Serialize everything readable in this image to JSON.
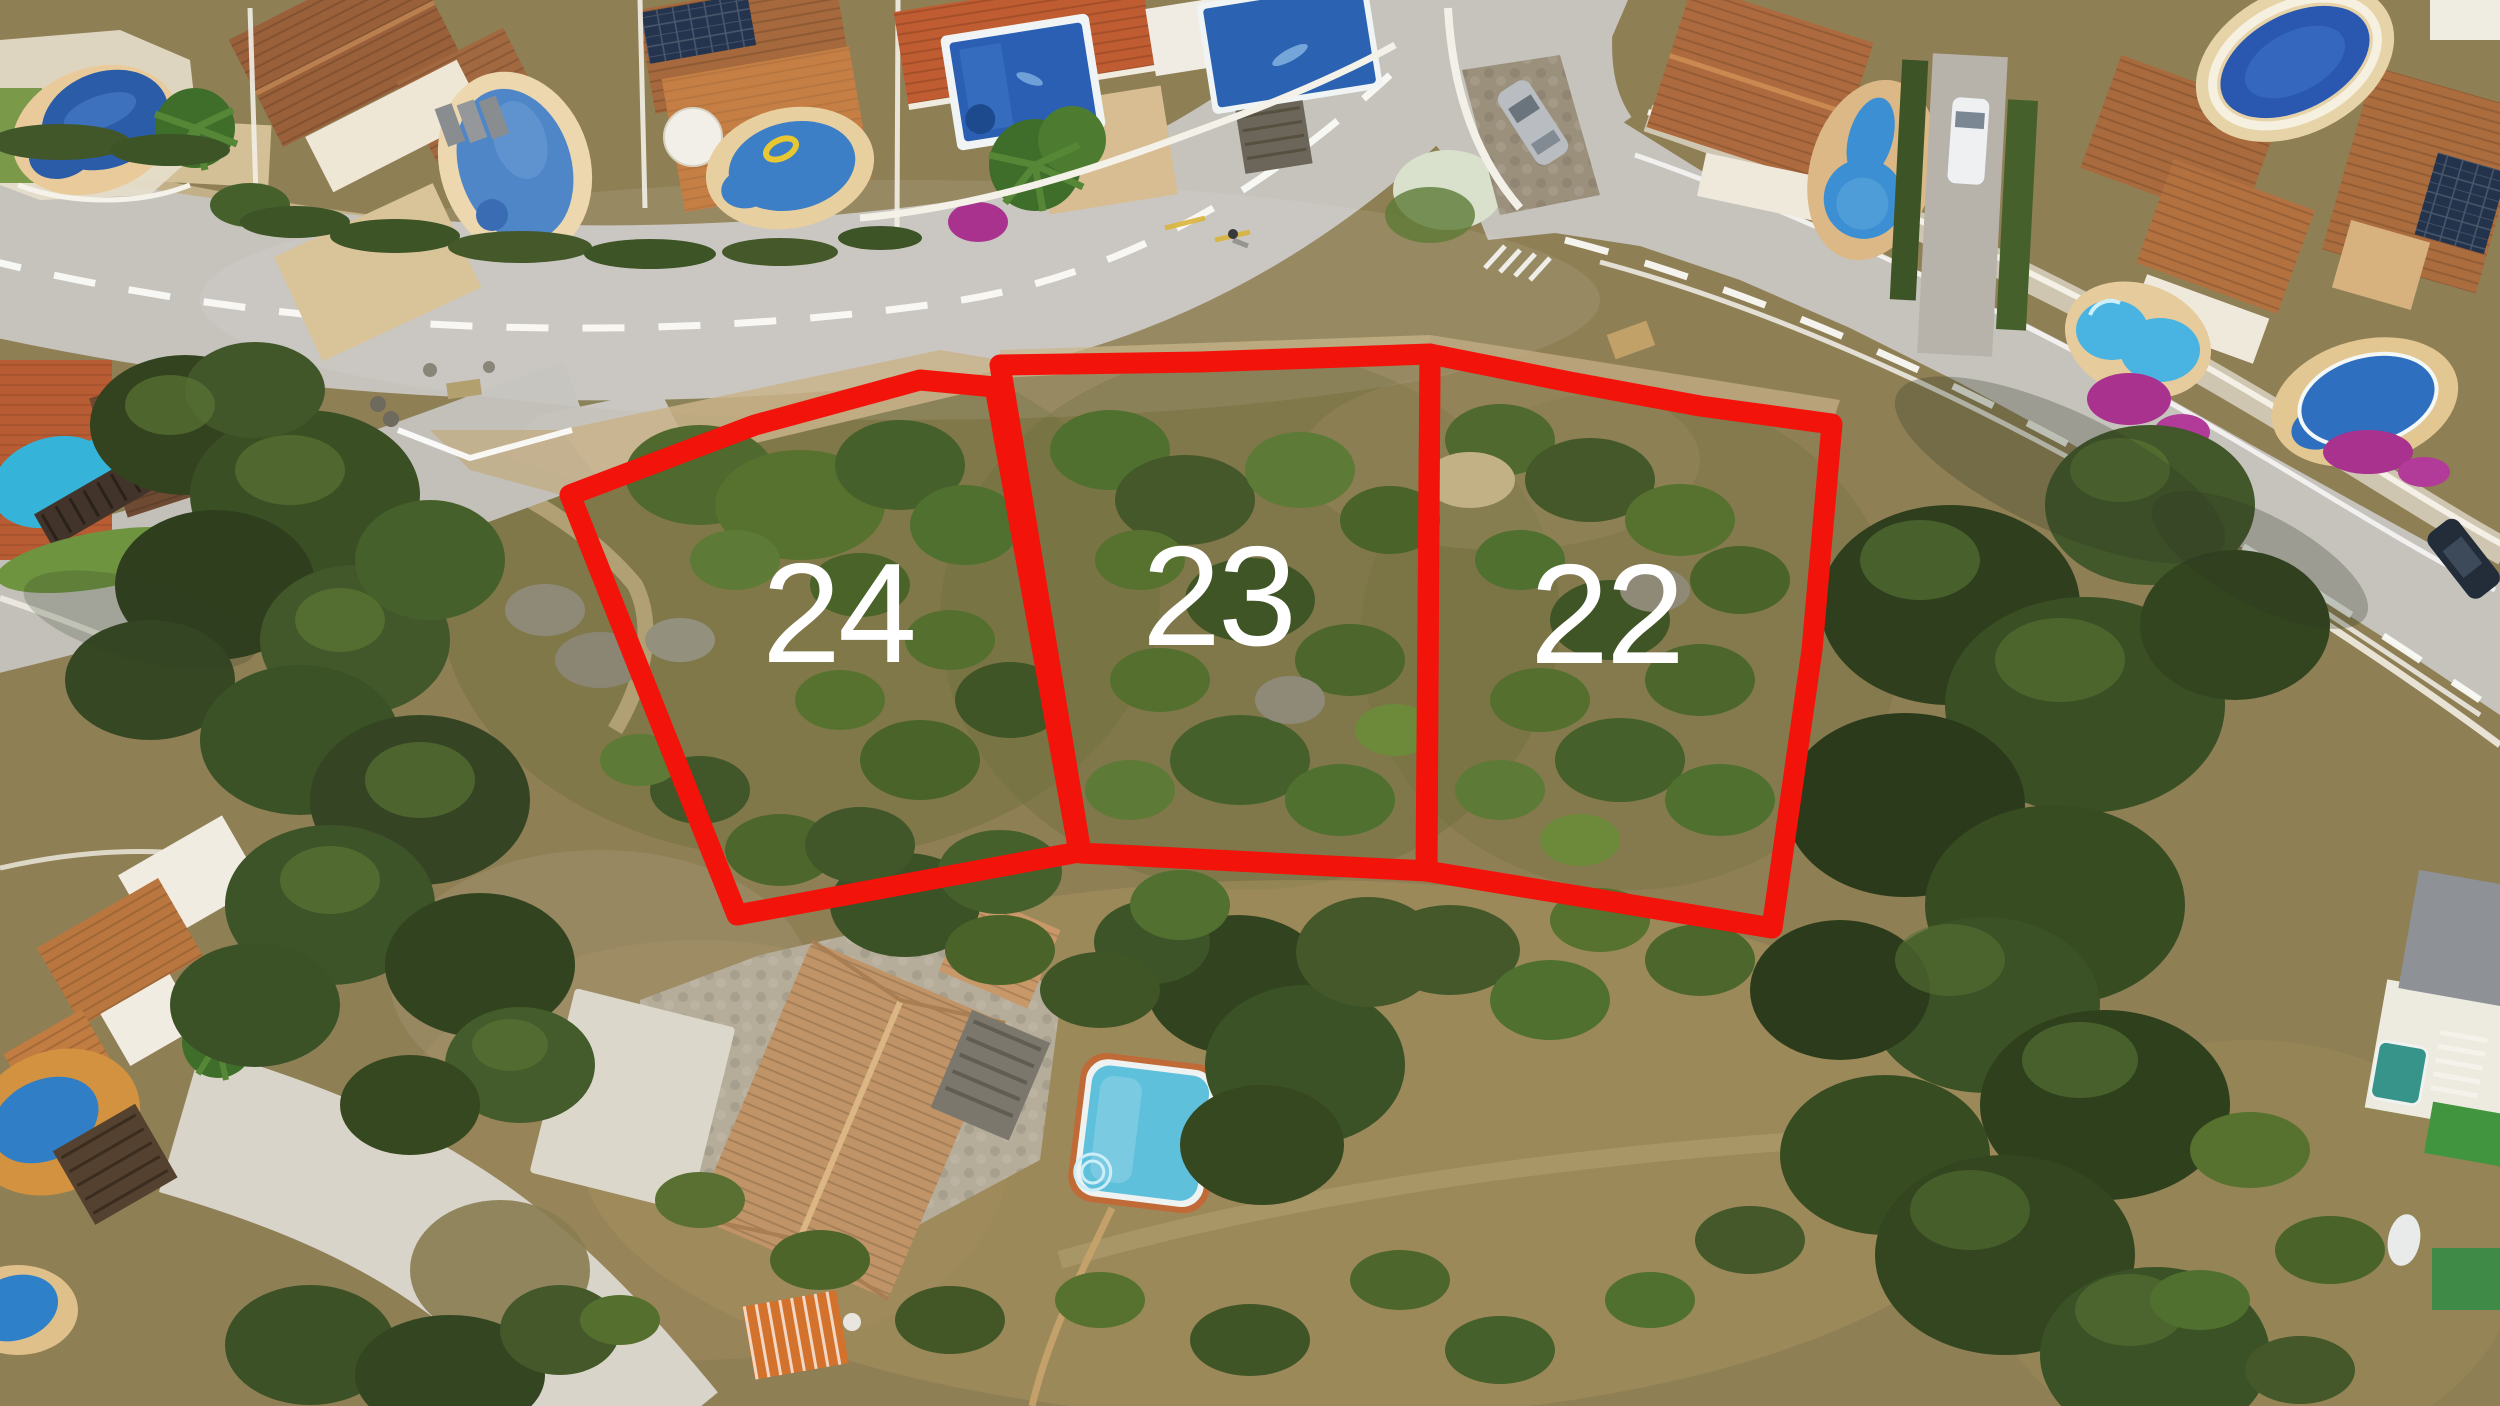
{
  "image": {
    "kind": "aerial-drone-photo-with-plot-annotation",
    "width": 2500,
    "height": 1406
  },
  "annotation": {
    "boundary_color": "#f2130a",
    "stroke_width": 21,
    "label_color": "#ffffff",
    "label_font_size": 142,
    "plots": [
      {
        "id": "plot-24",
        "label": "24",
        "points": "570,495 755,425 920,380 995,387 1079,852 737,915",
        "label_x": 838,
        "label_y": 662
      },
      {
        "id": "plot-23",
        "label": "23",
        "points": "1000,365 1200,362 1430,354 1427,871 1081,853",
        "label_x": 1218,
        "label_y": 645
      },
      {
        "id": "plot-22",
        "label": "22",
        "points": "1430,354 1570,382 1700,406 1832,424 1812,650 1772,928 1426,871",
        "label_x": 1606,
        "label_y": 663
      }
    ]
  },
  "palette": {
    "road_gray": "#c6c3bd",
    "road_shoulder_sand": "#c9b389",
    "scrub_base": "#8f7f55",
    "vegetation_dark": "#34431f",
    "vegetation_mid": "#4c662b",
    "vegetation_light": "#6d8a3b",
    "pool_deep_blue": "#2a5fb4",
    "pool_light_blue": "#5fc0dc",
    "roof_terracotta": "#ab6c3e",
    "bougainvillea_magenta": "#a8328e",
    "marking_white": "#fafaf5"
  }
}
